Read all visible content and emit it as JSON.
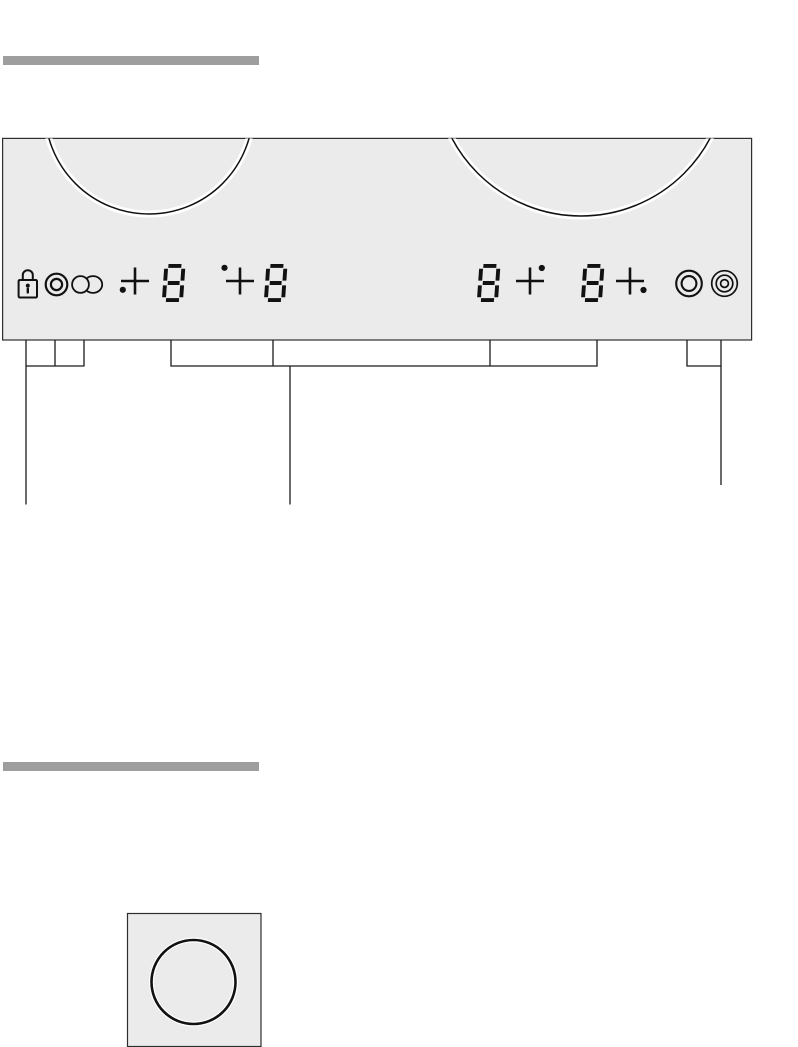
{
  "colors": {
    "panel_bg": "#ebebeb",
    "heading_bar": "#9e9e9e",
    "ink": "#111111",
    "callout_line": "#1a1a1a",
    "border": "#2e2e2e",
    "page_bg": "#ffffff",
    "glow": "#ffffff"
  },
  "control_panel": {
    "burners": [
      {
        "position": "left"
      },
      {
        "position": "right"
      }
    ],
    "left_icons": [
      {
        "name": "child-lock-icon",
        "symbol": "padlock"
      },
      {
        "name": "twin-ring-icon",
        "symbol": "double-circle"
      },
      {
        "name": "roaster-zone-icon",
        "symbol": "circle-with-oval"
      }
    ],
    "zone_keys": [
      {
        "name": "zone-key-front-left",
        "symbol": "cross-dot-bottom-left"
      },
      {
        "name": "zone-key-back-left",
        "symbol": "cross-dot-top-left"
      },
      {
        "name": "zone-key-back-right",
        "symbol": "cross-dot-top-right"
      },
      {
        "name": "zone-key-front-right",
        "symbol": "cross-dot-bottom-right"
      }
    ],
    "displays": [
      {
        "name": "display-front-left",
        "value": "8"
      },
      {
        "name": "display-back-left",
        "value": "8"
      },
      {
        "name": "display-back-right",
        "value": "8"
      },
      {
        "name": "display-front-right",
        "value": "8"
      }
    ],
    "right_icons": [
      {
        "name": "dual-circuit-icon",
        "symbol": "double-circle"
      },
      {
        "name": "triple-circuit-icon",
        "symbol": "triple-circle"
      }
    ]
  },
  "figure": {
    "hotplate_symbol": {
      "shape": "circle-in-square"
    }
  }
}
